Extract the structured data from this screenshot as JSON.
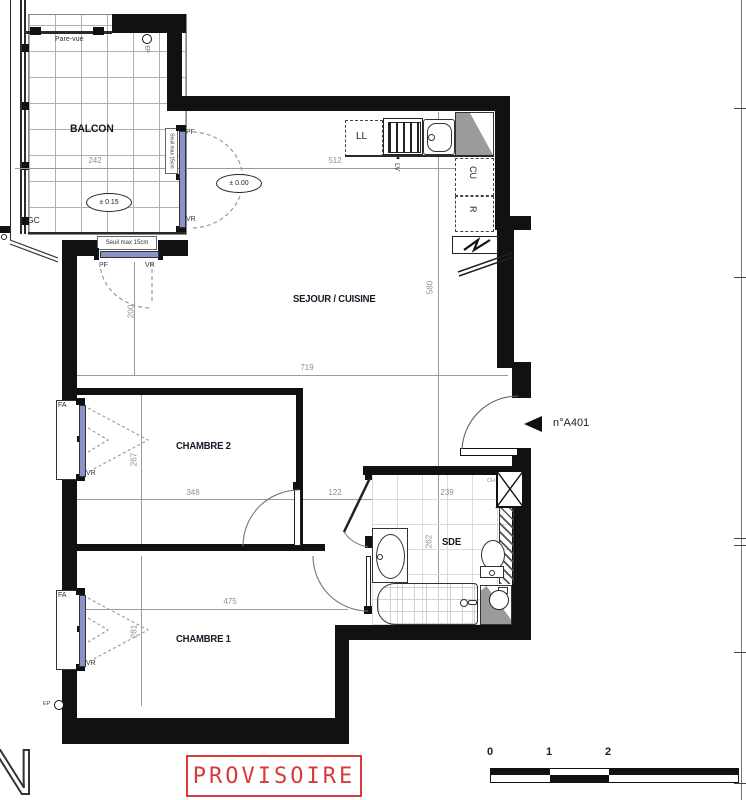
{
  "rooms": {
    "balcon": "BALCON",
    "sejour": "SEJOUR / CUISINE",
    "chambre2": "CHAMBRE 2",
    "chambre1": "CHAMBRE 1",
    "sde": "SDE"
  },
  "labels": {
    "pare_vue": "Pare-vue",
    "gc": "GC",
    "ep1": "EP",
    "ep2": "EP",
    "seuil1": "Seuil max 15cm",
    "seuil2": "Seuil max 15cm",
    "pf1": "PF",
    "vr1": "VR",
    "pf2": "PF",
    "vr2": "VR",
    "fa1": "FA",
    "vr3": "VR",
    "fa2": "FA",
    "vr4": "VR",
    "ll": "LL",
    "lv": "LV",
    "lv_arrow": "▲",
    "cu": "CU",
    "r": "R",
    "ch": "CH",
    "apartment": "n°A401",
    "level_balcony": "± 0.15",
    "level_interior": "± 0.00",
    "north": "N"
  },
  "dimensions": {
    "balcon_w": "242",
    "kitchen_w": "512",
    "sejour_w": "719",
    "sejour_h": "580",
    "window_h": "200",
    "ch2_w": "348",
    "ch2_h": "267",
    "hall_w": "122",
    "sde_w": "239",
    "sde_h": "262",
    "ch1_w": "475",
    "ch1_h": "281"
  },
  "stamp": {
    "text": "PROVISOIRE",
    "color": "#d93a3a"
  },
  "scale_bar": {
    "ticks": [
      "0",
      "1",
      "2",
      "4"
    ]
  },
  "colors": {
    "wall": "#111111",
    "glazing": "#8a93c7",
    "dim_gray": "#8f8f8f",
    "stamp_red": "#d93a3a"
  }
}
